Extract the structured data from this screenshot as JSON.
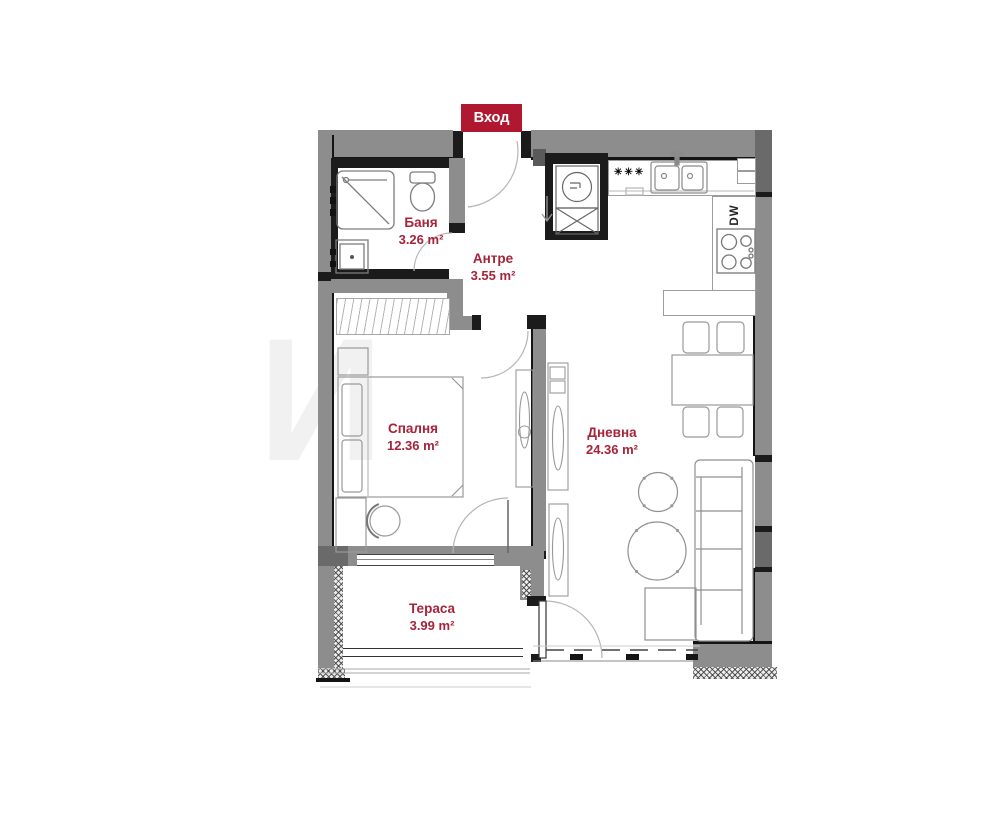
{
  "entrance": {
    "label": "Вход"
  },
  "rooms": {
    "bathroom": {
      "name": "Баня",
      "area": "3.26 m²"
    },
    "hallway": {
      "name": "Антре",
      "area": "3.55 m²"
    },
    "bedroom": {
      "name": "Спалня",
      "area": "12.36 m²"
    },
    "living": {
      "name": "Дневна",
      "area": "24.36 m²"
    },
    "terrace": {
      "name": "Тераса",
      "area": "3.99 m²"
    }
  },
  "kitchen": {
    "dishwasher_label": "DW",
    "fridge_marker": "✳✳✳"
  },
  "watermark": {
    "letter": "И"
  },
  "colors": {
    "accent": "#b01731",
    "labelRed": "#a62339",
    "wall": "#8d8d8d",
    "wallDark": "#6a6a6a",
    "black": "#1b1b1b",
    "furnitureLine": "#999999"
  }
}
